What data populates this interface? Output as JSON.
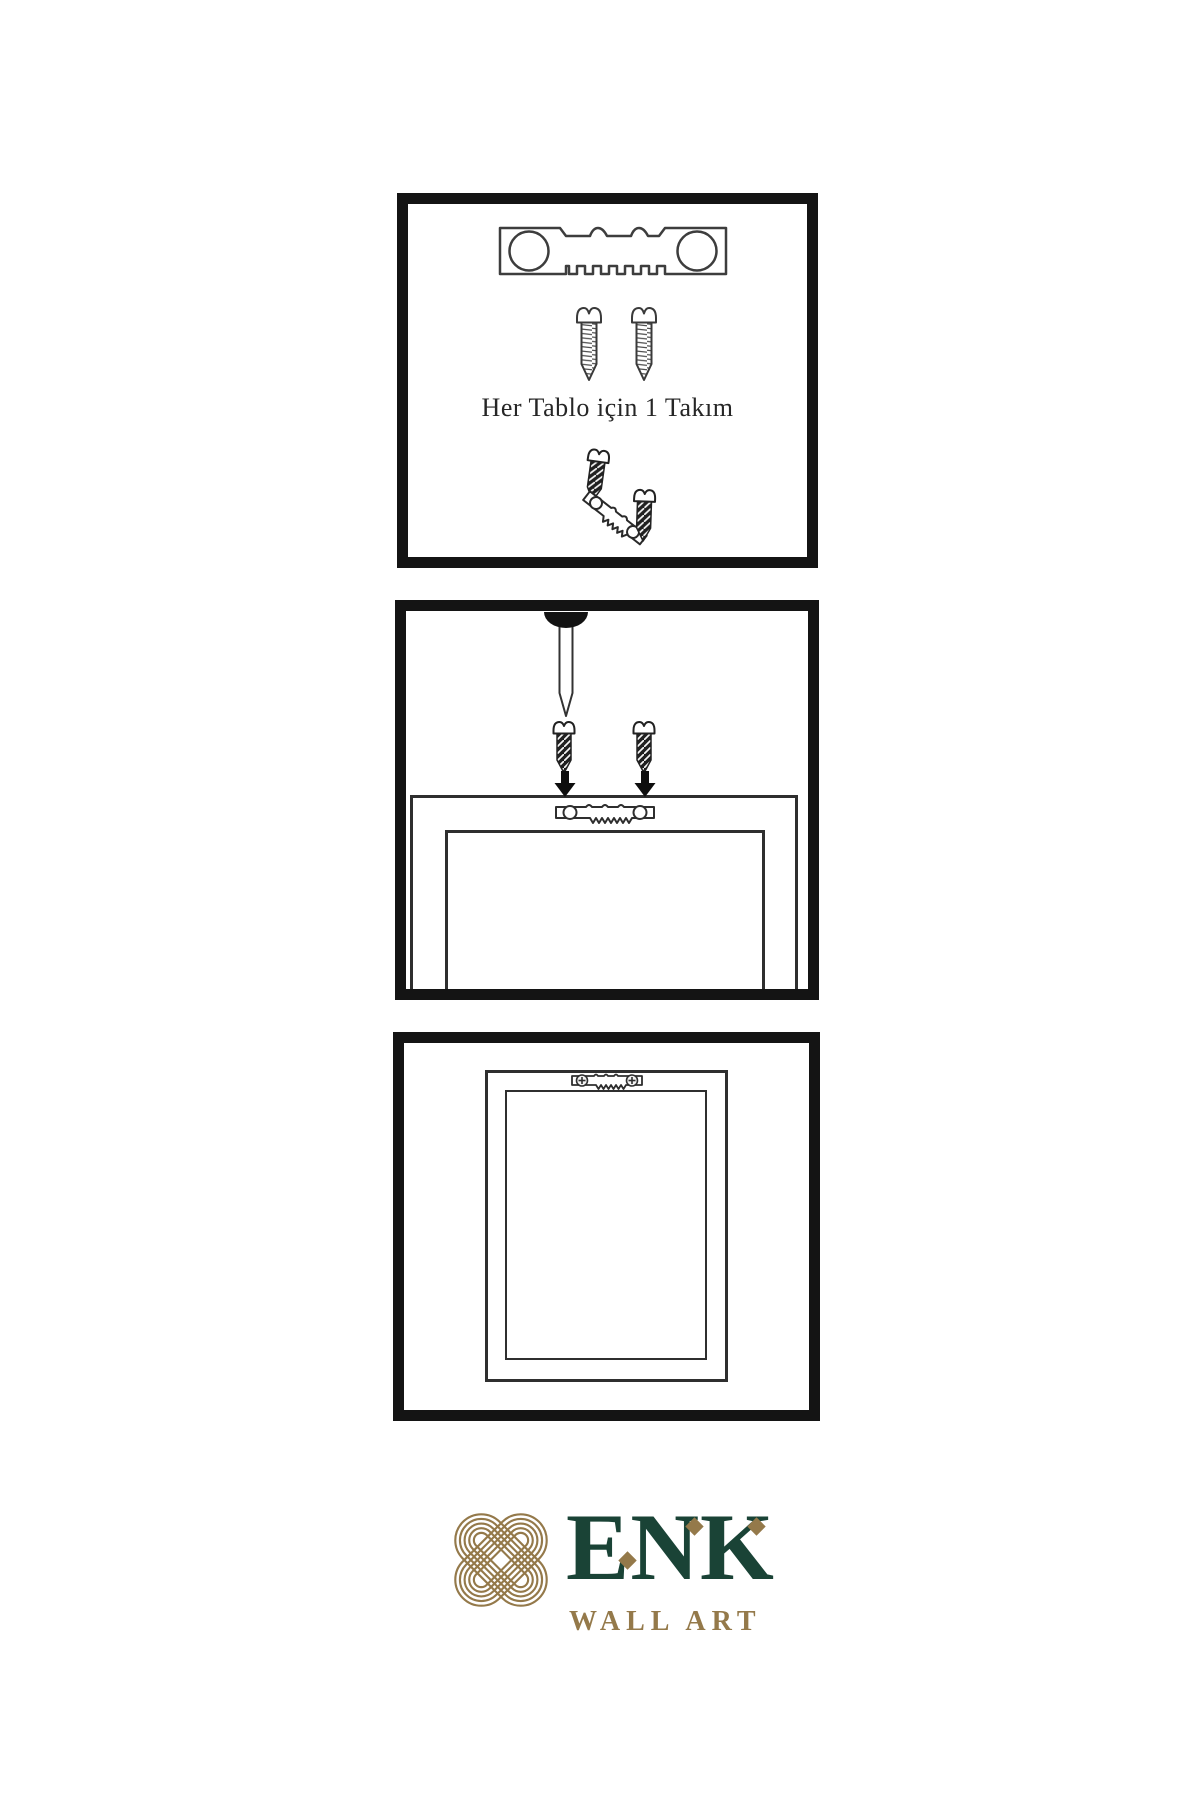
{
  "sheet": {
    "background": "#ffffff",
    "language": "Turkish",
    "type": "wall-art hanging instructions"
  },
  "colors": {
    "panel_border": "#141414",
    "line": "#2f2f2f",
    "logo_green": "#1a4336",
    "logo_gold": "#94794a",
    "caption_text": "#262626"
  },
  "panels": [
    {
      "name": "hardware-kit",
      "caption": "Her Tablo için 1 Takım",
      "icons": [
        "sawtooth-hanger",
        "screw",
        "screw",
        "screw-driving-into-angled-hanger"
      ]
    },
    {
      "name": "wall-mounting",
      "icons": [
        "nail-in-wall",
        "dark-screw",
        "dark-screw",
        "down-arrow",
        "down-arrow",
        "frame-back-with-sawtooth-hanger"
      ]
    },
    {
      "name": "frame-hung-on-wall",
      "icons": [
        "frame-back-with-screwed-sawtooth-hanger"
      ]
    }
  ],
  "logo": {
    "brand": "ENK",
    "subtitle": "WALL ART",
    "mark": "interlocking-knot"
  }
}
